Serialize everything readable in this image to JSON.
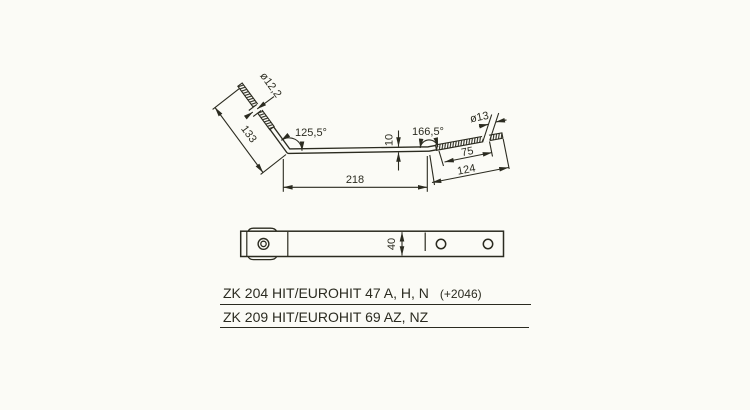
{
  "drawing": {
    "type": "technical-diagram",
    "description": "Bent threaded tine bracket shown in side view and top view with dimensions",
    "colors": {
      "line": "#2b2b20",
      "background": "#fbfbf6"
    },
    "side_view": {
      "labels": {
        "thread_diameter_left": "ø12,2",
        "arm_length_left": "133",
        "bend_angle_left": "125,5°",
        "bar_thickness": "10",
        "bar_length": "218",
        "bend_angle_right": "166,5°",
        "thread_length_right": "75",
        "arm_length_right": "124",
        "thread_diameter_right": "ø13"
      }
    },
    "top_view": {
      "labels": {
        "bar_width": "40"
      },
      "hole_count": 2
    }
  },
  "catalog": {
    "line1_main": "ZK 204  HIT/EUROHIT 47 A, H, N",
    "line1_suffix": "(+2046)",
    "line2_main": "ZK 209  HIT/EUROHIT 69 AZ, NZ"
  }
}
